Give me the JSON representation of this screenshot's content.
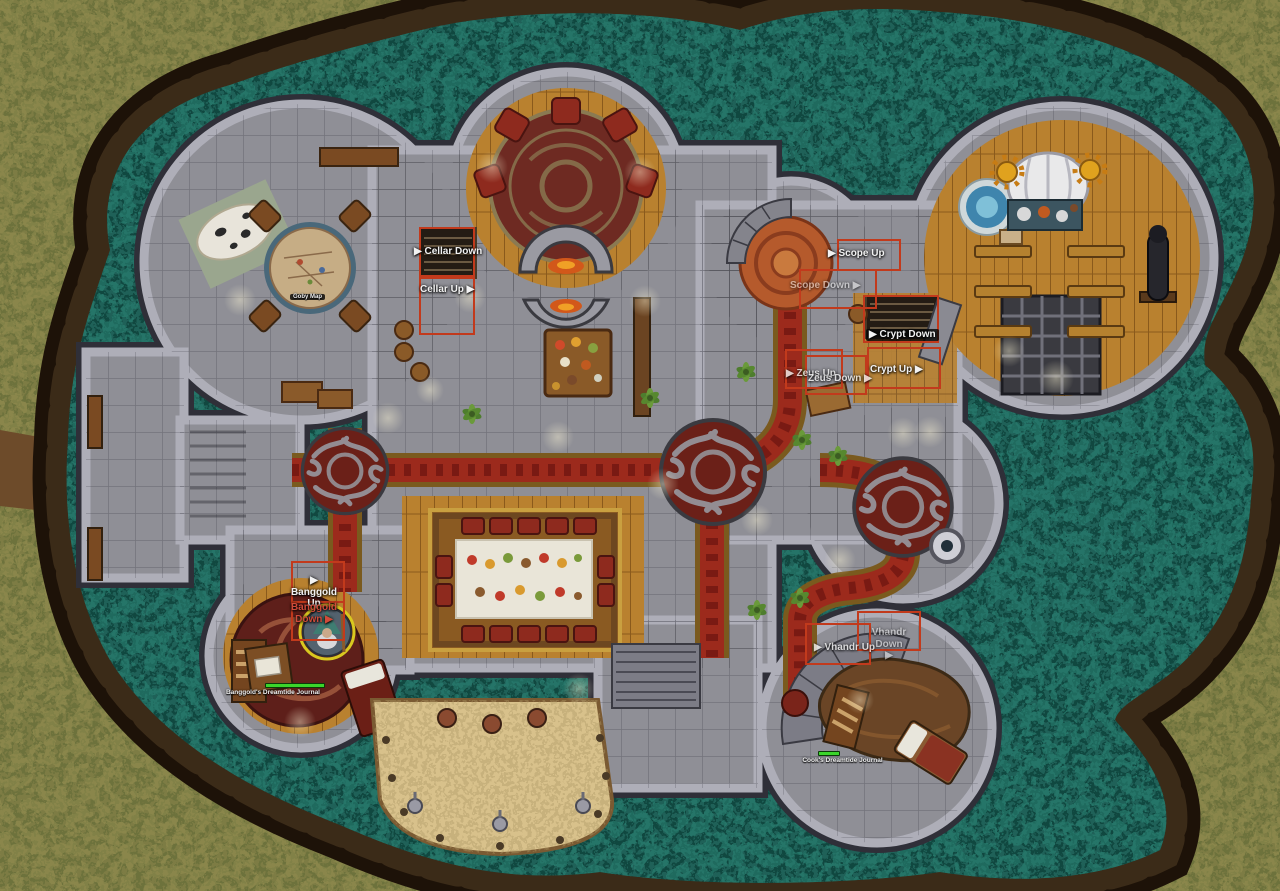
{
  "scene": {
    "type": "vtt-battlemap",
    "description": "Top-down castle ground floor surrounded by a teal moat and tree-ring border"
  },
  "stairway_labels": {
    "cellar_down": "▶ Cellar Down",
    "cellar_up": "Cellar Up ▶",
    "scope_up": "▶ Scope Up",
    "scope_down": "Scope Down ▶",
    "crypt_down": "▶ Crypt Down",
    "crypt_up": "Crypt Up ▶",
    "zeus_up": "▶ Zeus Up",
    "zeus_down": "Zeus Down ▶",
    "banggold_up": "▶ Banggold\nUp",
    "banggold_down": "Banggold\nDown ▶",
    "vhandr_down": "Vhandr Down\n▶",
    "vhandr_up": "▶ Vhandr Up"
  },
  "tokens": {
    "goby_map": {
      "label": "Goby Map"
    },
    "banggold_journal": {
      "label": "Banggold's Dreamtide Journal",
      "hp_percent": 100
    },
    "cook_journal": {
      "label": "Cook's Dreamtide Journal",
      "hp_percent": 100
    }
  },
  "colors": {
    "water": "#1f6158",
    "grass": "#7d7c44",
    "tree_ring": "#1d1208",
    "stone_floor": "#8f8f96",
    "wall": "#aeaeb8",
    "wood": "#b9812f",
    "carpet_red": "#9c2a1c",
    "carpet_gold": "#7a5a1e",
    "rug_maroon": "#6b2018",
    "trigger_box_red": "#c23a1c",
    "hp_green": "#3bd52b",
    "label_red": "#cf4b3a"
  }
}
